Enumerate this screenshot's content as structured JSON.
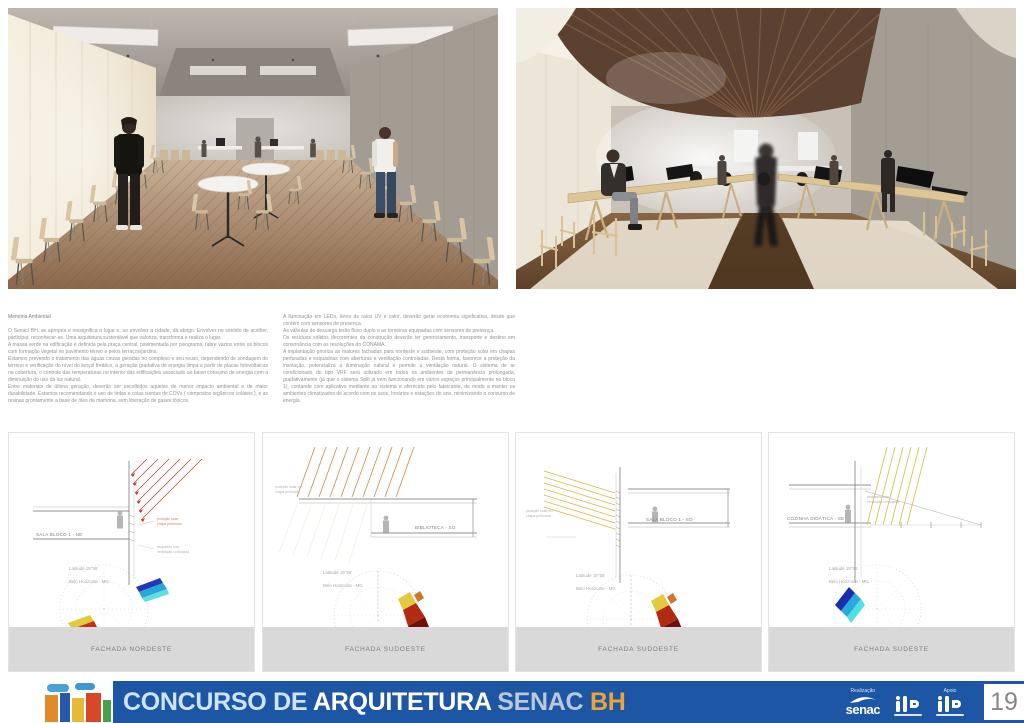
{
  "text_block": {
    "left": {
      "title": "Memória Ambiental",
      "body": "O Senac/ BH, se apropria e ressignifica o lugar e, ao envolver a cidade, dá abrigo. Envolver no sentido de acolher, participar, reconhecer-se. Uma arquitetura sustentável que valoriza, transforma e realiza o lugar.\nA massa verde na edificação é definida pela praça central, pavimentada por pisograma, (abre vazios entre os blocos com formação vegetal no pavimento térreo e pelos terraços/jardins.\nEstamos prevendo o tratamento das águas cinzas geradas no complexo e seu reuso, dependendo de sondagem do terreno e verificação do nível do lençol freático, a geração gradativa de energia limpa a partir de placas fotovoltaicas na cobertura, o controle das temperaturas no interior das edificações associado ao baixo consumo de energia com a diminuição do uso da luz natural.\nEntre materiais de última geração, deverão ser escolhidos aqueles de menor impacto ambiental e de maior durabilidade. Estamos recomendando o uso de tintas e colas isentas de COVs ( compostos orgânicos voláteis ), e as resinas prontamente a base de óleo de mamona, sem liberação de gases tóxicos."
    },
    "right": {
      "body": "A iluminação em LEDs, livres de raios UV e calor, deverão gerar economia significativa, desde que contém com sensores de presença.\nAs válvulas de descarga terão fluxo duplo e as torneiras equipadas com sensores de presença.\nOs resíduos sólidos decorrentes da construção deverão ter gerenciamento, transporte e destino em consonância com as resoluções do CONAMA.\nA implantação prioriza as maiores fachadas para nordeste e sudoeste, com proteção solar em chapas perfuradas e esquadrias com aberturas e ventilação controladas. Desta forma, favorece a proteção da insolação, potencializa a iluminação natural e permite a ventilação natural. O sistema de ar condicionado do tipo VRF será utilizado em todos os ambientes de permanência prolongada, gradativamente (já que o sistema Split já vem funcionando em vários espaços principalmente no bloco 1), contando com aplicativo mediante ao sistema e oferecido pelo fabricante, de modo a manter os ambientes climatizados de acordo com os usos, horários e estações do ano, minimizando o consumo de energia."
    }
  },
  "panels": [
    {
      "label": "FACHADA NORDESTE",
      "section_label": "SALA BLOCO 1 - NE",
      "latitude_line1": "Latitude 19°55'",
      "latitude_line2": "Belo Horizonte - MG",
      "note1": "proteção solar\nchapa perfurada",
      "note2": "esquadria com\nventilação controlada"
    },
    {
      "label": "FACHADA SUDOESTE",
      "section_label": "BIBLIOTECA - SO",
      "latitude_line1": "Latitude 19°55'",
      "latitude_line2": "Belo Horizonte - MG",
      "note1": "proteção solar em\nchapa perfurada",
      "note2": ""
    },
    {
      "label": "FACHADA SUDOESTE",
      "section_label": "SALA BLOCO 1 - SO",
      "latitude_line1": "Latitude 19°55'",
      "latitude_line2": "Belo Horizonte - MG",
      "note1": "proteção solar em\nchapa perfurada",
      "note2": ""
    },
    {
      "label": "FACHADA SUDESTE",
      "section_label": "COZINHA DIDÁTICA - SE",
      "latitude_line1": "Latitude 19°55'",
      "latitude_line2": "Belo Horizonte - MG",
      "note1": "esquadria com\nventilação controlada",
      "note2": ""
    }
  ],
  "footer": {
    "title_part1": "CONCURSO DE ",
    "title_part2": "ARQUITETURA",
    "title_part3": " SENAC ",
    "title_part4": "BH",
    "realizacao_label": "Realização",
    "apoio_label": "Apoio",
    "senac_text": "senac",
    "page_number": "19",
    "colors": {
      "bar_blue": "#1d56a4",
      "title_light_blue": "#cfe3f7",
      "title_white": "#ffffff",
      "senac_gray": "#b9c8da",
      "bh_orange": "#e9a43c"
    }
  }
}
